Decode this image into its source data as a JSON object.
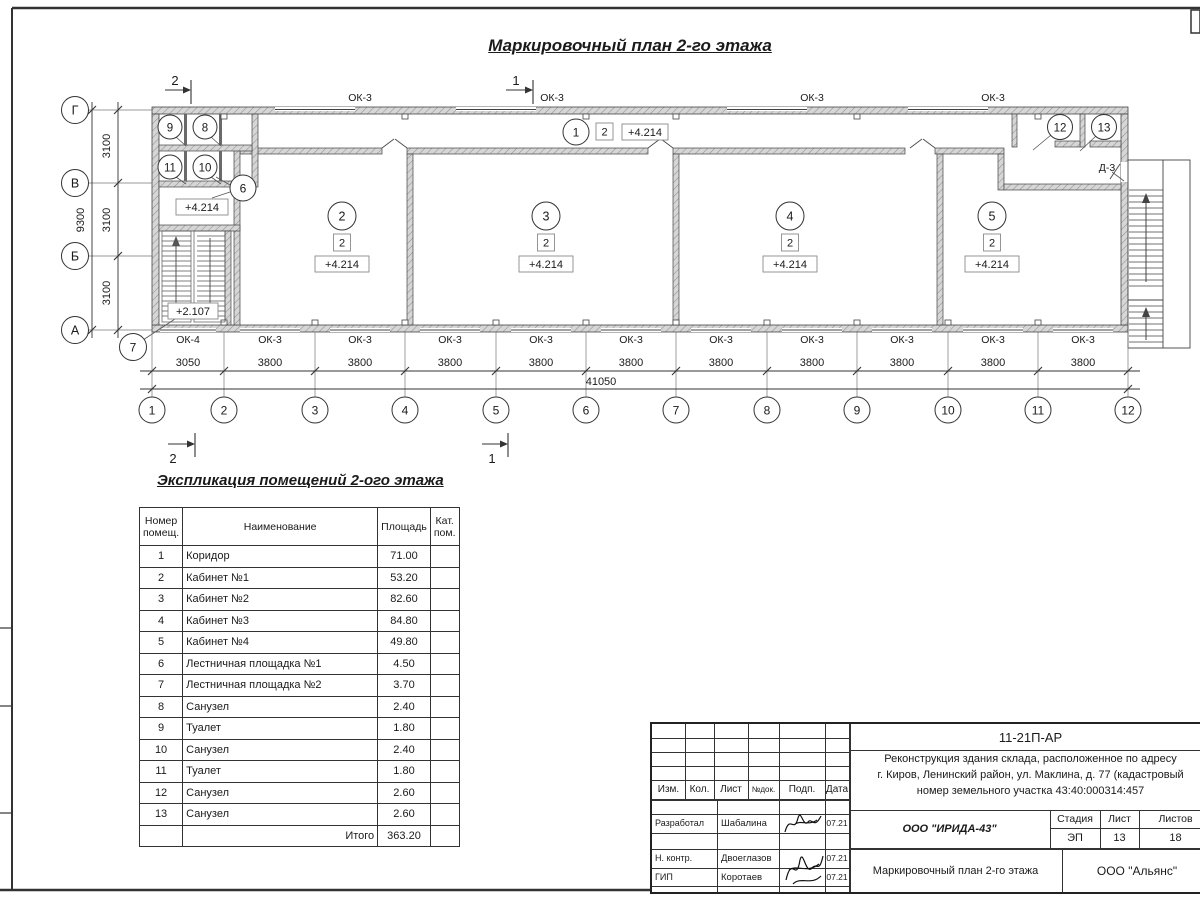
{
  "sheet": {
    "title": "Маркировочный план 2-го этажа"
  },
  "plan": {
    "axis_letters": [
      "Г",
      "В",
      "Б",
      "А"
    ],
    "axis_numbers": [
      "1",
      "2",
      "3",
      "4",
      "5",
      "6",
      "7",
      "8",
      "9",
      "10",
      "11",
      "12"
    ],
    "v_dims": [
      "3100",
      "3100",
      "3100"
    ],
    "v_total": "9300",
    "h_dims": [
      "3050",
      "3800",
      "3800",
      "3800",
      "3800",
      "3800",
      "3800",
      "3800",
      "3800",
      "3800",
      "3800"
    ],
    "h_total": "41050",
    "top_window_labels": [
      "ОК-3",
      "ОК-3",
      "ОК-3",
      "ОК-3"
    ],
    "bottom_window_labels": [
      "ОК-4",
      "ОК-3",
      "ОК-3",
      "ОК-3",
      "ОК-3",
      "ОК-3",
      "ОК-3",
      "ОК-3",
      "ОК-3",
      "ОК-3",
      "ОК-3"
    ],
    "door_label": "Д-3",
    "room_numbers": [
      "1",
      "2",
      "3",
      "4",
      "5",
      "6",
      "7",
      "8",
      "9",
      "10",
      "11",
      "12",
      "13"
    ],
    "category_mark": "2",
    "elevation_main": "+4.214",
    "elevation_stair": "+2.107",
    "section_mark_1": "1",
    "section_mark_2": "2"
  },
  "schedule": {
    "title": "Экспликация помещений 2-ого этажа",
    "col_num": "Номер помещ.",
    "col_name": "Наименование",
    "col_area": "Площадь",
    "col_cat": "Кат. пом.",
    "rows": [
      {
        "num": "1",
        "name": "Коридор",
        "area": "71.00"
      },
      {
        "num": "2",
        "name": "Кабинет №1",
        "area": "53.20"
      },
      {
        "num": "3",
        "name": "Кабинет №2",
        "area": "82.60"
      },
      {
        "num": "4",
        "name": "Кабинет №3",
        "area": "84.80"
      },
      {
        "num": "5",
        "name": "Кабинет №4",
        "area": "49.80"
      },
      {
        "num": "6",
        "name": "Лестничная площадка №1",
        "area": "4.50"
      },
      {
        "num": "7",
        "name": "Лестничная площадка №2",
        "area": "3.70"
      },
      {
        "num": "8",
        "name": "Санузел",
        "area": "2.40"
      },
      {
        "num": "9",
        "name": "Туалет",
        "area": "1.80"
      },
      {
        "num": "10",
        "name": "Санузел",
        "area": "2.40"
      },
      {
        "num": "11",
        "name": "Туалет",
        "area": "1.80"
      },
      {
        "num": "12",
        "name": "Санузел",
        "area": "2.60"
      },
      {
        "num": "13",
        "name": "Санузел",
        "area": "2.60"
      }
    ],
    "total_label": "Итого",
    "total_area": "363.20"
  },
  "titleblock": {
    "doc_number": "11-21П-АР",
    "project_line1": "Реконструкция здания склада, расположенное по адресу",
    "project_line2": "г. Киров, Ленинский район, ул. Маклина, д. 77 (кадастровый",
    "project_line3": "номер земельного участка 43:40:000314:457",
    "col_izm": "Изм.",
    "col_kol": "Кол.",
    "col_list": "Лист",
    "col_dok": "№док.",
    "col_podp": "Подп.",
    "col_data": "Дата",
    "row1_role": "Разработал",
    "row1_name": "Шабалина",
    "row1_date": "07.21",
    "row2_role": "Н. контр.",
    "row2_name": "Двоеглазов",
    "row2_date": "07.21",
    "row3_role": "ГИП",
    "row3_name": "Коротаев",
    "row3_date": "07.21",
    "company": "ООО \"ИРИДА-43\"",
    "stage_label": "Стадия",
    "sheet_label": "Лист",
    "sheets_label": "Листов",
    "stage": "ЭП",
    "sheet_num": "13",
    "sheets_total": "18",
    "doc_title": "Маркировочный план 2-го этажа",
    "org": "ООО \"Альянс\""
  }
}
